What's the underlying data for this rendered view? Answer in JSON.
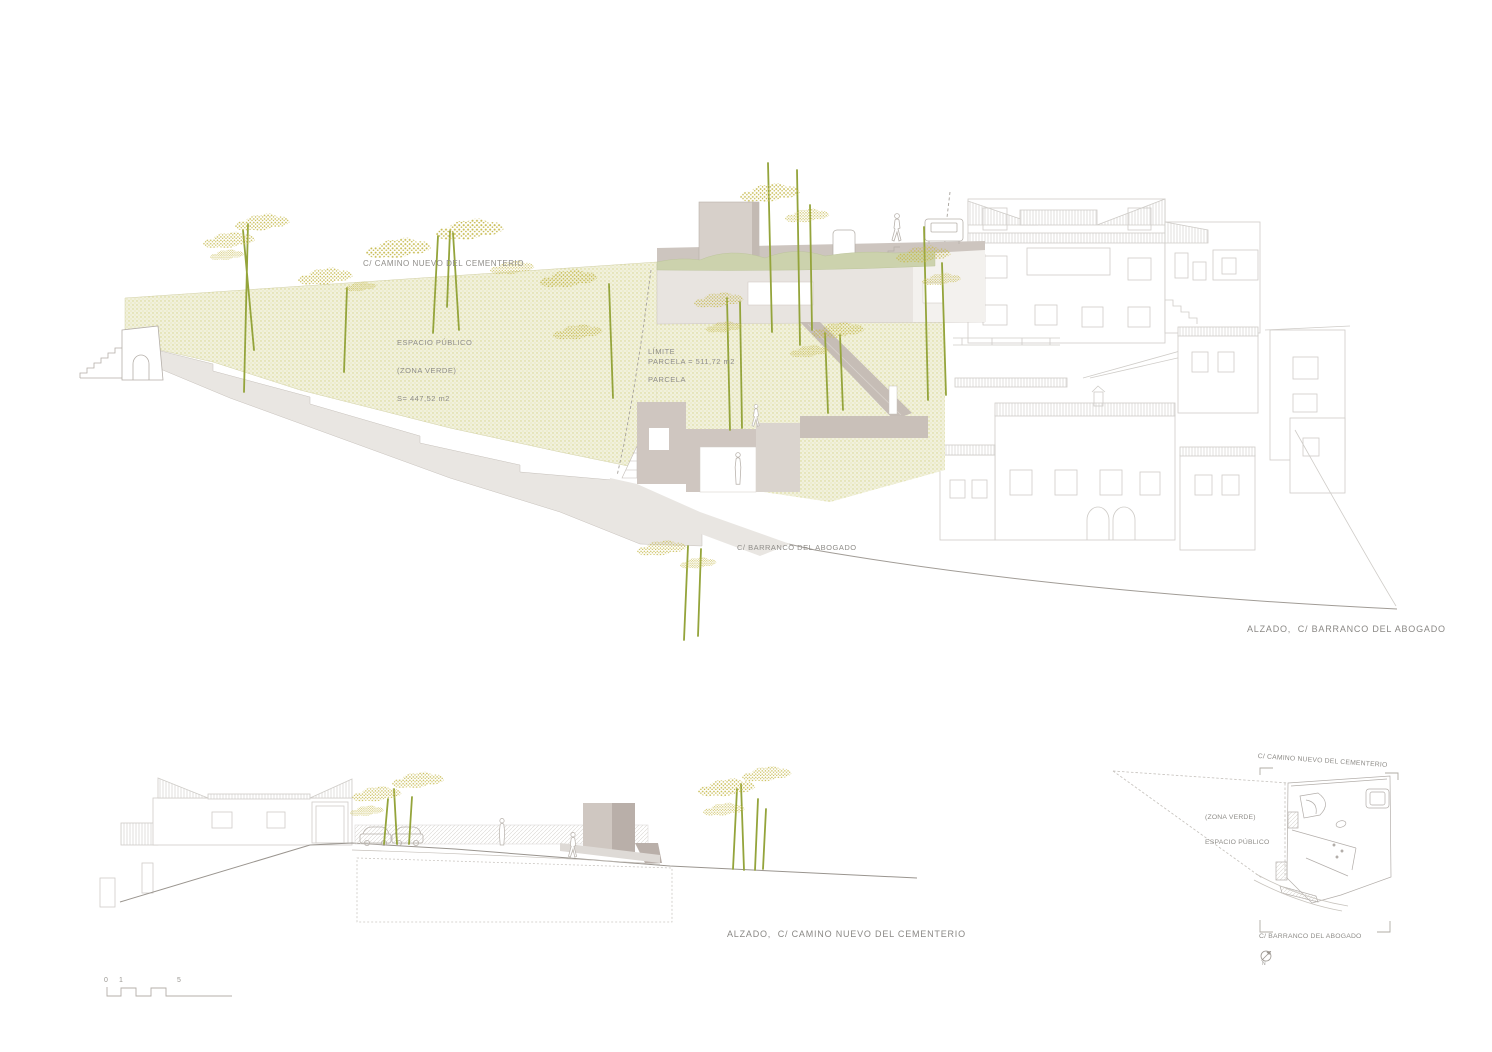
{
  "palette": {
    "paper": "#ffffff",
    "house_line": "#cfccc8",
    "mid_line": "#b3aea8",
    "ground_line": "#9c9791",
    "text_grey": "#8f8d89",
    "green_zone_base": "#f1f1dd",
    "green_zone_dot": "#d7d58c",
    "green_roof": "#ccd2ad",
    "tree_stem": "#94a43b",
    "tree_canopy": "#c9bd55",
    "taupe_light": "#d7d0ca",
    "taupe_mid": "#cbc2bb",
    "taupe_dark": "#b9afa9",
    "slab_grey": "#e8e4e0",
    "terrain_grey": "#e9e6e2"
  },
  "labels": {
    "main_elevation": {
      "street_top": "C/ CAMINO NUEVO DEL CEMENTERIO",
      "espacio_line1": "ESPACIO PÚBLICO",
      "espacio_line2": "(ZONA VERDE)",
      "espacio_line3": "S= 447,52 m2",
      "limite_line1": "LÍMITE",
      "limite_line2": "PARCELA",
      "parcela": "PARCELA = 511,72 m2",
      "street_bottom": "C/ BARRANCO DEL ABOGADO",
      "title": "ALZADO,  C/ BARRANCO DEL ABOGADO"
    },
    "secondary_elevation": {
      "title": "ALZADO,  C/ CAMINO NUEVO DEL CEMENTERIO"
    },
    "site_plan": {
      "street_top": "C/ CAMINO NUEVO DEL CEMENTERIO",
      "zona_line1": "(ZONA VERDE)",
      "zona_line2": "ESPACIO PÚBLICO",
      "street_bottom": "C/ BARRANCO DEL ABOGADO",
      "north": "N"
    },
    "scale_bar": {
      "t0": "0",
      "t1": "1",
      "t5": "5"
    }
  }
}
